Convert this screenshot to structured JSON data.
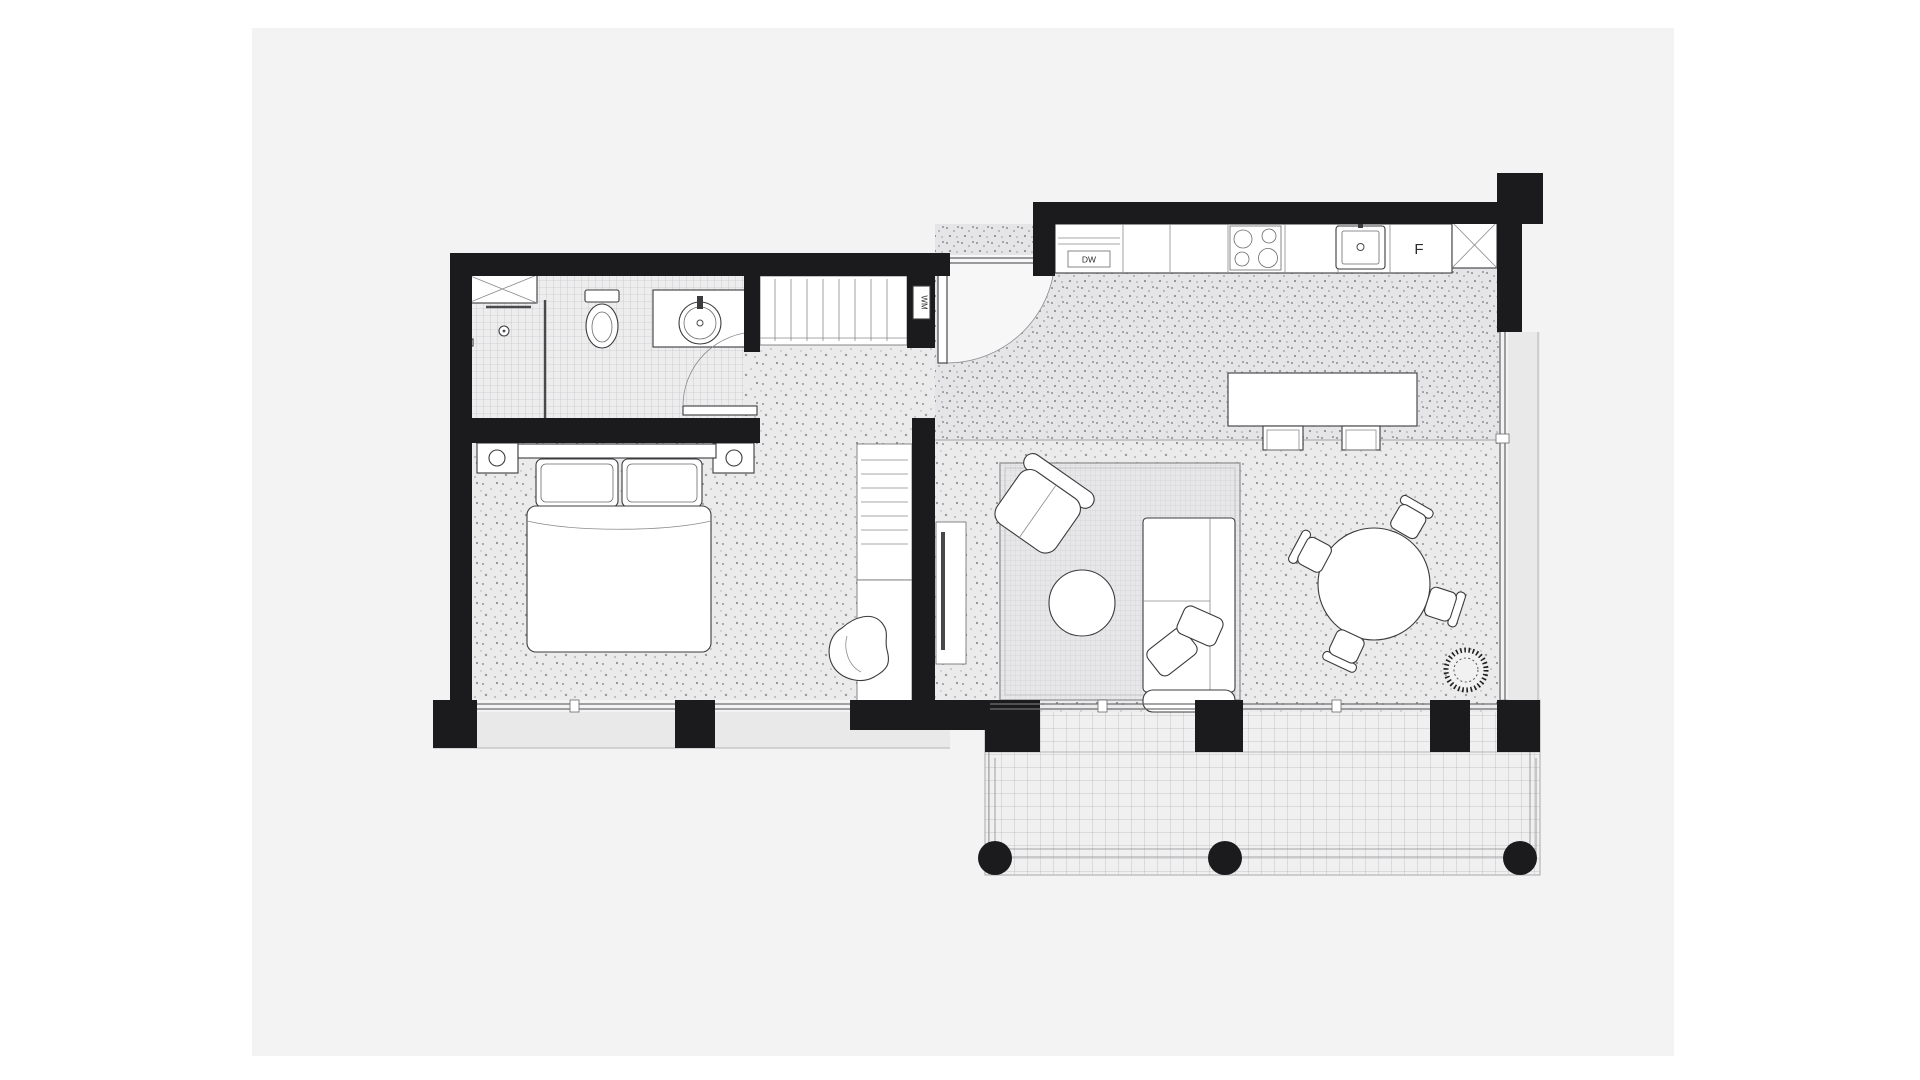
{
  "page": {
    "background": "#ffffff",
    "canvas_background": "#f3f3f4"
  },
  "plan": {
    "type": "apartment-floor-plan",
    "labels": {
      "fridge": "F",
      "dishwasher": "DW",
      "washing_machine": "WM"
    },
    "colors": {
      "wall": "#1b1b1d",
      "floor_base": "#ebebec",
      "floor_dot": "#98989b",
      "kitchen_floor_base": "#e6e6e8",
      "tile_line": "#b9b9bc",
      "rug_line": "#c8c8ca",
      "deck_line": "#b9b9bb",
      "furniture_stroke": "#3b3b3e",
      "glazing": "#6f6f72",
      "exterior_band": "#e9e9ea"
    },
    "rooms": {
      "bathroom": {
        "fixtures": [
          "shaft-x",
          "shower-set",
          "glass-screen",
          "toilet",
          "vanity-with-round-sink",
          "swing-door"
        ]
      },
      "hall_closet": {
        "fixtures": [
          "wardrobe-rail",
          "washing-machine-niche"
        ]
      },
      "bedroom": {
        "fixtures": [
          "double-bed",
          "pillows",
          "nightstand-left",
          "lamp",
          "nightstand-right",
          "lamp",
          "built-in-wardrobe",
          "desk",
          "lounge-chair"
        ]
      },
      "entry": {
        "fixtures": [
          "entry-swing-door",
          "threshold"
        ]
      },
      "kitchen": {
        "fixtures": [
          "counter-run",
          "dishwasher-box",
          "cooktop-4-burners",
          "square-sink",
          "fridge-cell",
          "shaft-x",
          "island-table",
          "stool",
          "stool"
        ]
      },
      "living": {
        "fixtures": [
          "area-rug",
          "armchair",
          "round-coffee-table",
          "l-shaped-sofa",
          "sofa-pillows",
          "tv-sideboard"
        ]
      },
      "dining": {
        "fixtures": [
          "round-table",
          "chair",
          "chair",
          "chair",
          "chair",
          "potted-plant"
        ]
      },
      "balcony": {
        "fixtures": [
          "deck-grid",
          "railing",
          "round-column",
          "round-column",
          "round-column"
        ]
      }
    }
  }
}
